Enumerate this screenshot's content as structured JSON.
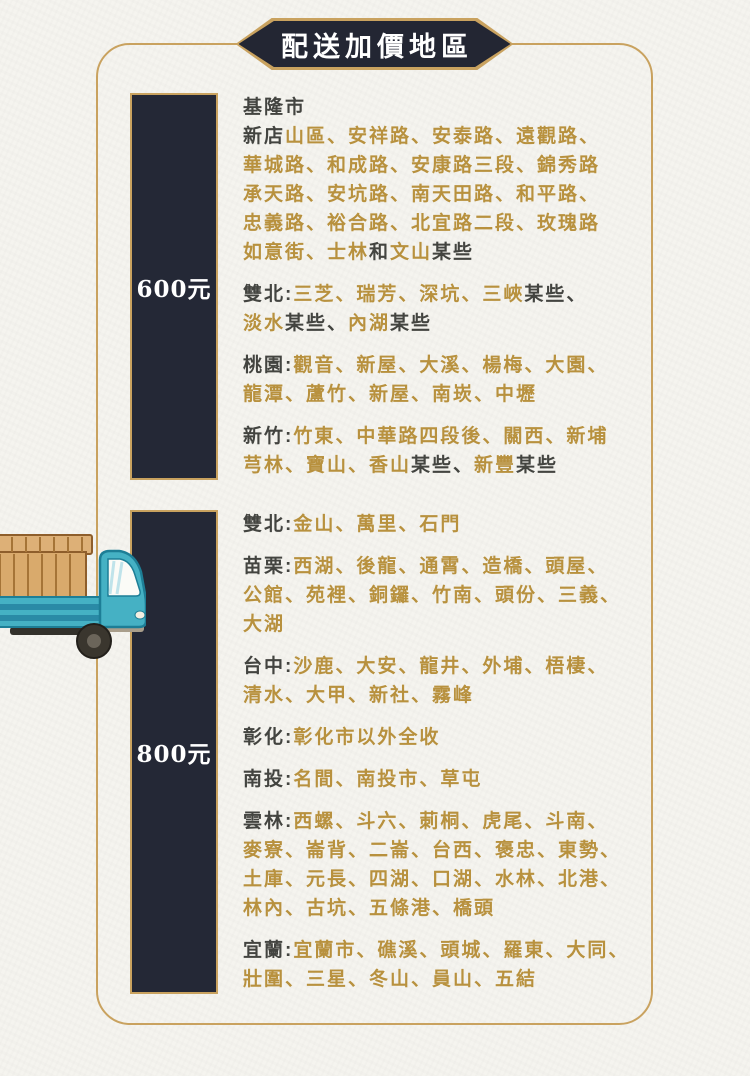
{
  "page": {
    "title": "配送加價地區",
    "colors": {
      "gold": "#b8913e",
      "dark_text": "#434440",
      "panel": "#242836",
      "frame_gold": "#c9a25f",
      "banner_bg": "#232633",
      "background": "#f5f4ef",
      "white": "#ffffff",
      "truck_teal": "#45b1c4",
      "crate_tan": "#d9aa6c"
    },
    "icons": {
      "truck": "delivery-truck-illustration"
    }
  },
  "sections": [
    {
      "price_label": "600元",
      "blocks": [
        {
          "segments": [
            {
              "t": "基隆市",
              "c": "dark"
            }
          ]
        },
        {
          "segments": [
            {
              "t": "新店",
              "c": "dark"
            },
            {
              "t": "山區、安祥路、安泰路、遠觀路、\n華城路、和成路、安康路三段、錦秀路\n承天路、安坑路、南天田路、和平路、\n忠義路、裕合路、北宜路二段、玫瑰路\n如意街、士林",
              "c": "gold"
            },
            {
              "t": "和",
              "c": "dark"
            },
            {
              "t": "文山",
              "c": "gold"
            },
            {
              "t": "某些",
              "c": "dark"
            }
          ]
        },
        {
          "segments": [
            {
              "t": "雙北:",
              "c": "dark"
            },
            {
              "t": "三芝、瑞芳、深坑、三峽",
              "c": "gold"
            },
            {
              "t": "某些、\n",
              "c": "dark"
            },
            {
              "t": "淡水",
              "c": "gold"
            },
            {
              "t": "某些、",
              "c": "dark"
            },
            {
              "t": "內湖",
              "c": "gold"
            },
            {
              "t": "某些",
              "c": "dark"
            }
          ]
        },
        {
          "segments": [
            {
              "t": "桃園:",
              "c": "dark"
            },
            {
              "t": "觀音、新屋、大溪、楊梅、大園、\n龍潭、蘆竹、新屋、南崁、中壢",
              "c": "gold"
            }
          ]
        },
        {
          "segments": [
            {
              "t": "新竹:",
              "c": "dark"
            },
            {
              "t": "竹東、中華路四段後、關西、新埔\n芎林、寶山、香山",
              "c": "gold"
            },
            {
              "t": "某些、",
              "c": "dark"
            },
            {
              "t": "新豐",
              "c": "gold"
            },
            {
              "t": "某些",
              "c": "dark"
            }
          ]
        }
      ]
    },
    {
      "price_label": "800元",
      "blocks": [
        {
          "segments": [
            {
              "t": "雙北:",
              "c": "dark"
            },
            {
              "t": "金山、萬里、石門",
              "c": "gold"
            }
          ]
        },
        {
          "segments": [
            {
              "t": "苗栗:",
              "c": "dark"
            },
            {
              "t": "西湖、後龍、通霄、造橋、頭屋、\n公館、苑裡、銅鑼、竹南、頭份、三義、\n大湖",
              "c": "gold"
            }
          ]
        },
        {
          "segments": [
            {
              "t": "台中:",
              "c": "dark"
            },
            {
              "t": "沙鹿、大安、龍井、外埔、梧棲、\n清水、大甲、新社、霧峰",
              "c": "gold"
            }
          ]
        },
        {
          "segments": [
            {
              "t": "彰化:",
              "c": "dark"
            },
            {
              "t": "彰化市以外全收",
              "c": "gold"
            }
          ]
        },
        {
          "segments": [
            {
              "t": "南投:",
              "c": "dark"
            },
            {
              "t": "名間、南投市、草屯",
              "c": "gold"
            }
          ]
        },
        {
          "segments": [
            {
              "t": "雲林:",
              "c": "dark"
            },
            {
              "t": "西螺、斗六、莿桐、虎尾、斗南、\n麥寮、崙背、二崙、台西、褒忠、東勢、\n土庫、元長、四湖、口湖、水林、北港、\n林內、古坑、五條港、橋頭",
              "c": "gold"
            }
          ]
        },
        {
          "segments": [
            {
              "t": "宜蘭:",
              "c": "dark"
            },
            {
              "t": "宜蘭市、礁溪、頭城、羅東、大同、\n壯圍、三星、冬山、員山、五結",
              "c": "gold"
            }
          ]
        }
      ]
    }
  ]
}
